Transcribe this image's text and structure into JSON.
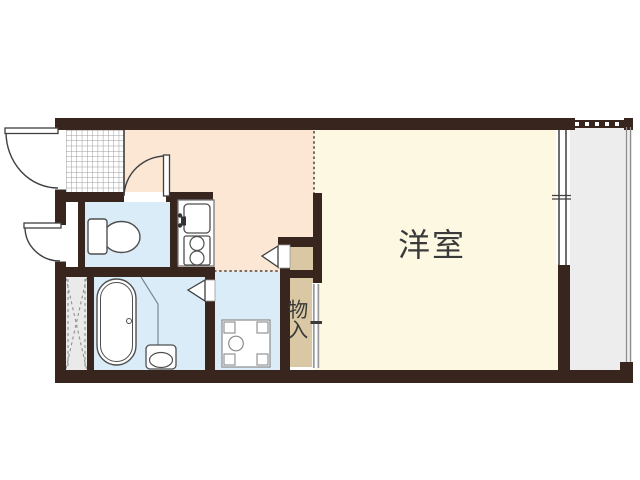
{
  "plan": {
    "type": "apartment-floor-plan",
    "labels": {
      "western_room": "洋室",
      "closet": "物入",
      "closet_chars": [
        "物",
        "入"
      ]
    },
    "palette": {
      "wall": "#38261e",
      "dining_kitchen_floor": "#fbe7d4",
      "western_room_floor": "#fdf8e2",
      "wet_area_floor": "#daecf8",
      "closet_floor": "#d9c8a3",
      "balcony_floor": "#ededed",
      "pipe_space_fill": "#eaeaea",
      "meter_box_fill": "#ffffff",
      "genkan_tile_line": "#9c9c9c",
      "fixture_outline": "#4f4f4f",
      "door_outline": "#3f3f3f",
      "dotted_line": "#6f6f6f",
      "label_text": "#3a3a3a"
    },
    "fixtures": [
      "entrance-door",
      "meter-box-door",
      "toilet",
      "toilet-door",
      "kitchen-sink",
      "faucet",
      "two-burner-stove",
      "bathtub",
      "bath-partition",
      "wash-basin",
      "bathroom-folding-door",
      "washing-machine-pan",
      "closet-folding-door",
      "closet-sliding-door",
      "sliding-window",
      "balcony-railing",
      "pipe-space-hatch",
      "genkan-tile"
    ]
  }
}
